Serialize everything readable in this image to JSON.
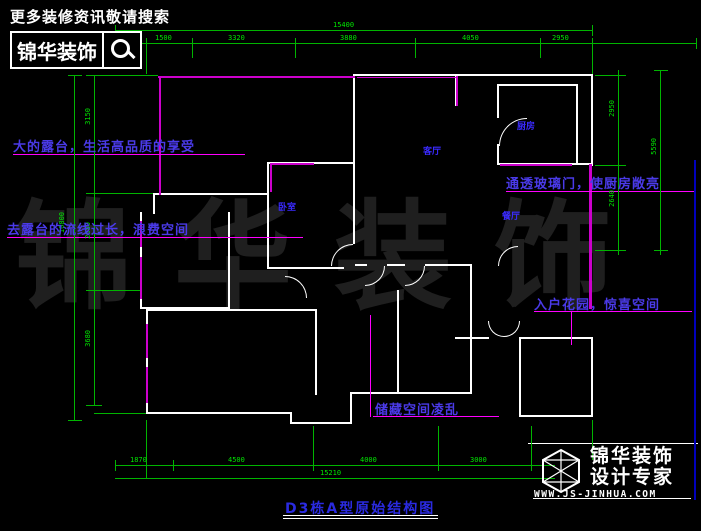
{
  "banner": {
    "tagline": "更多装修资讯敬请搜索",
    "brand": "锦华装饰"
  },
  "annotations": {
    "terrace": "大的露台，生活高品质的享受",
    "flow": "去露台的流线过长，浪费空间",
    "glass_door": "通透玻璃门，使厨房敞亮",
    "entry_garden": "入户花园，惊喜空间",
    "storage": "储藏空间凌乱"
  },
  "rooms": {
    "living": "客厅",
    "kitchen": "厨房",
    "dining": "餐厅",
    "bedroom": "卧室"
  },
  "dimensions": {
    "top": {
      "total": "15400",
      "segments": [
        "1500",
        "3320",
        "3880",
        "4050",
        "2950"
      ]
    },
    "bottom": {
      "total": "15210",
      "segments": [
        "1870",
        "4500",
        "4000",
        "3000"
      ]
    },
    "left": {
      "total": "10800",
      "segments": [
        "3150",
        "2880",
        "3680"
      ]
    },
    "right": {
      "total": "5590",
      "segments": [
        "2950",
        "2640"
      ]
    }
  },
  "drawing_title": "D3栋A型原始结构图",
  "watermark": "锦华装饰",
  "footer_logo": {
    "brand": "锦华装饰",
    "subtitle": "设计专家",
    "website": "WWW.JS-JINHUA.COM"
  },
  "colors": {
    "background": "#000000",
    "wall": "#ffffff",
    "accent_wall": "#cc00cc",
    "leader": "#ff00ff",
    "dimension": "#00b400",
    "dimension_text": "#00e600",
    "annotation_text": "#4a3ae8",
    "room_label": "#3a2aff",
    "title_text": "#2a2ae0",
    "frame_blue": "#0000bb"
  }
}
